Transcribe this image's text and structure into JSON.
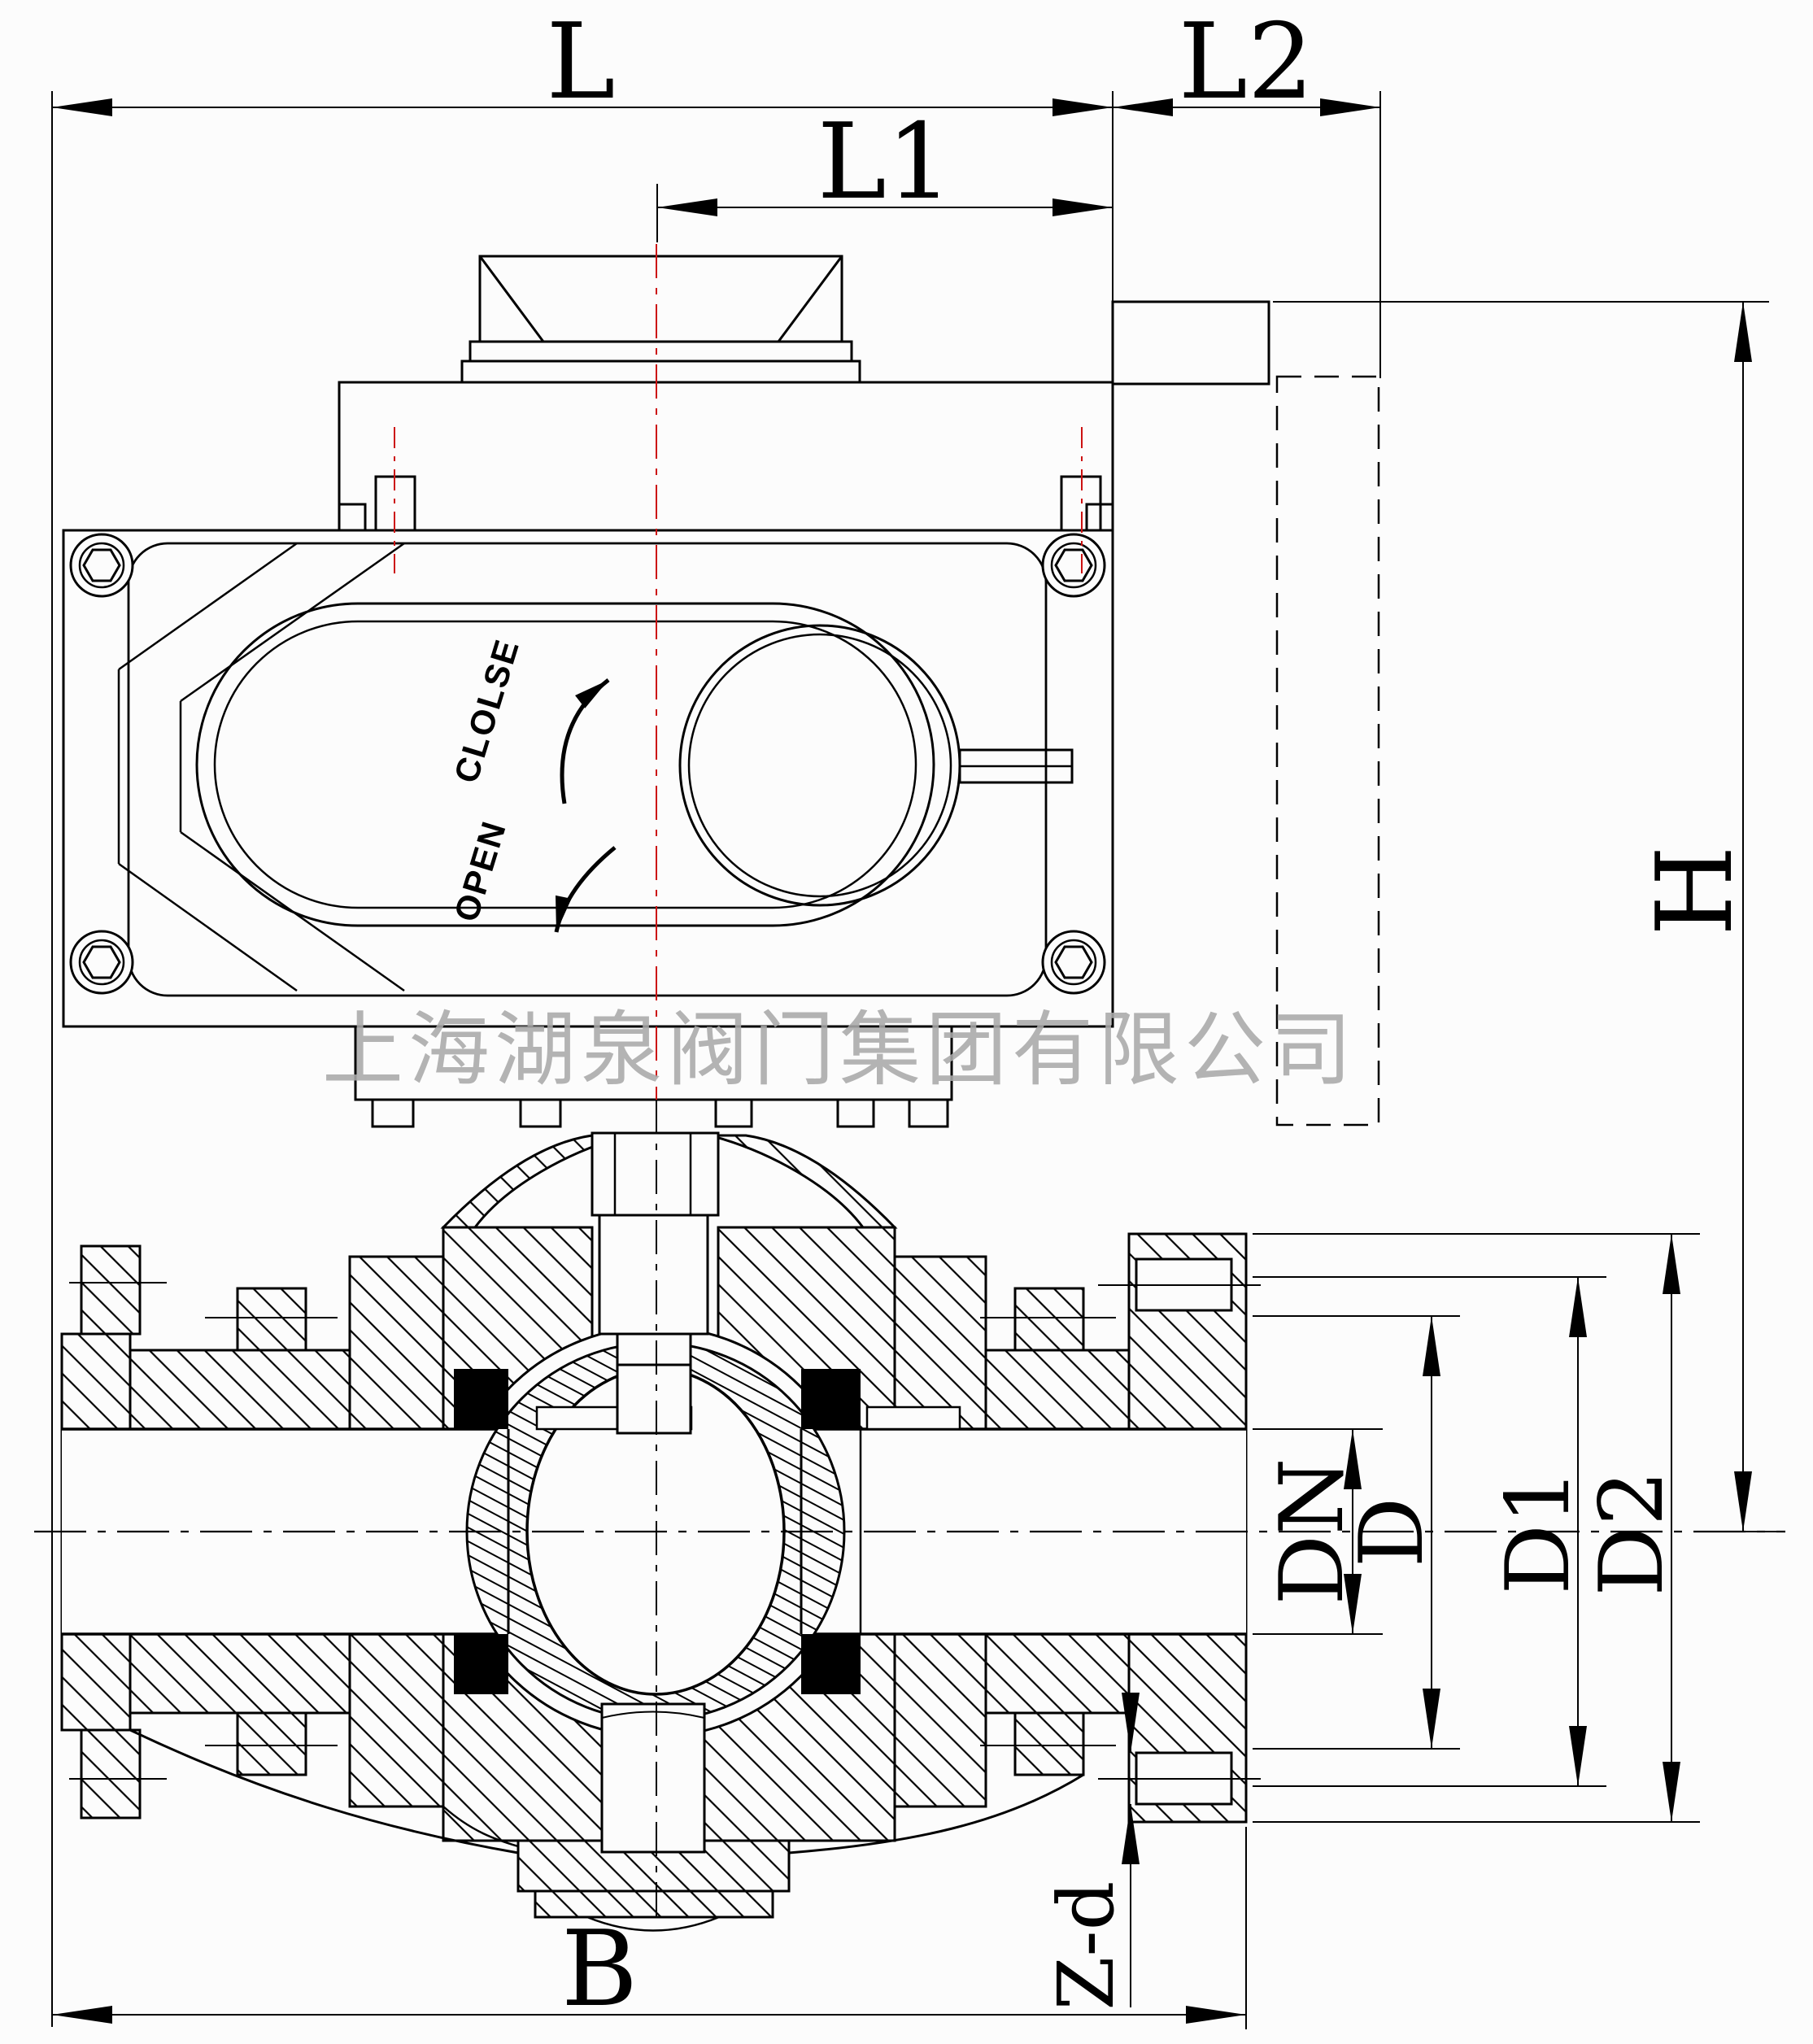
{
  "drawing": {
    "title_watermark": "上海湖泉阀门集团有限公司",
    "actuator": {
      "close_label": "CLOLSE",
      "open_label": "OPEN"
    },
    "dimensions": {
      "L": {
        "label": "L"
      },
      "L1": {
        "label": "L1"
      },
      "L2": {
        "label": "L2"
      },
      "H": {
        "label": "H"
      },
      "DN": {
        "label": "DN"
      },
      "D": {
        "label": "D"
      },
      "D1": {
        "label": "D1"
      },
      "D2": {
        "label": "D2"
      },
      "B": {
        "label": "B"
      },
      "Zd": {
        "label": "Z-d"
      }
    },
    "colors": {
      "line": "#000000",
      "centerline_red": "#cc1111",
      "watermark_gray": "#a9a9a9",
      "background": "#fcfcfc"
    }
  }
}
